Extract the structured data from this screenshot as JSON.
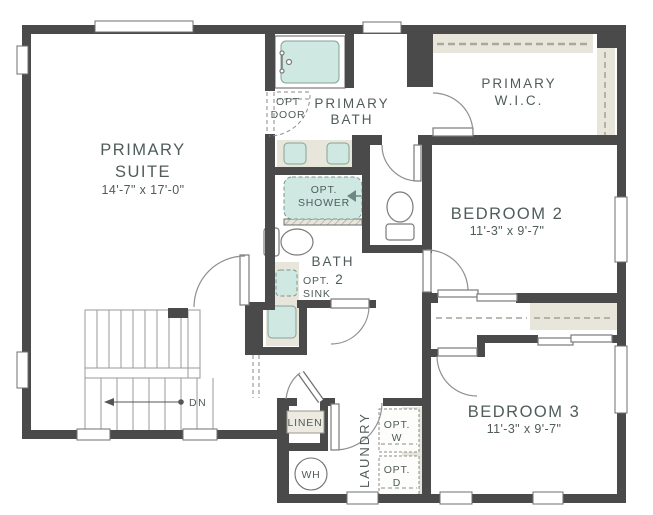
{
  "rooms": {
    "primary_suite": {
      "line1": "PRIMARY",
      "line2": "SUITE",
      "dims": "14'-7\" x 17'-0\""
    },
    "primary_bath": {
      "line1": "PRIMARY",
      "line2": "BATH"
    },
    "primary_wic": {
      "line1": "PRIMARY",
      "line2": "W.I.C."
    },
    "bedroom2": {
      "name": "BEDROOM 2",
      "dims": "11'-3\" x 9'-7\""
    },
    "bedroom3": {
      "name": "BEDROOM 3",
      "dims": "11'-3\" x 9'-7\""
    },
    "bath2": {
      "line1": "BATH",
      "line2": "2"
    },
    "laundry": {
      "name": "LAUNDRY"
    },
    "linen": {
      "name": "LINEN"
    }
  },
  "options": {
    "door": {
      "line1": "OPT",
      "line2": "DOOR"
    },
    "shower": {
      "line1": "OPT.",
      "line2": "SHOWER"
    },
    "sink": {
      "line1": "OPT.",
      "line2": "SINK"
    },
    "washer": {
      "line1": "OPT.",
      "line2": "W"
    },
    "dryer": {
      "line1": "OPT.",
      "line2": "D"
    }
  },
  "annotations": {
    "down": "DN",
    "water_heater": "WH"
  },
  "colors": {
    "wall": "#4a4a4a",
    "fixture": "#cfe8e2",
    "counter": "#e8e5db",
    "text": "#4f5c5b",
    "line": "#8f8f8f"
  }
}
